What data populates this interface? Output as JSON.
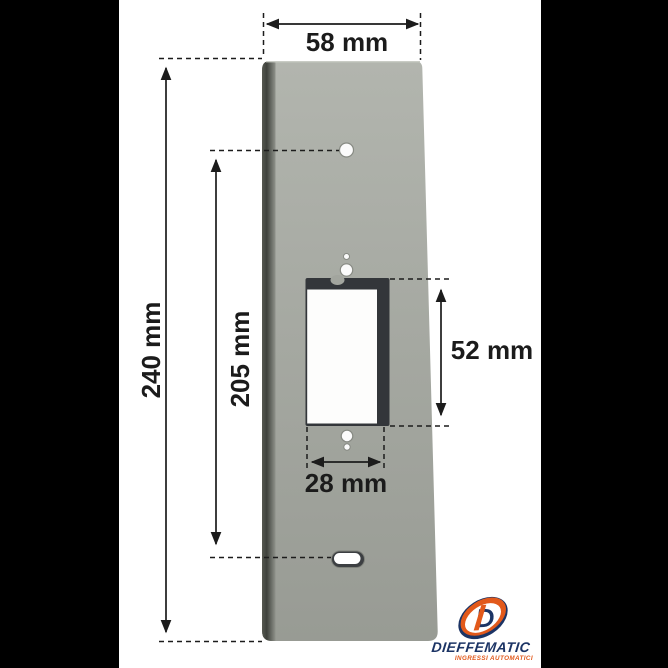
{
  "page": {
    "background": "#ffffff",
    "letterbox_color": "#000000"
  },
  "drawing": {
    "type": "dimensioned technical drawing",
    "subject": "rectangular mounting plate with central cutout, front view",
    "units": "mm",
    "labels": {
      "plate_width": "58 mm",
      "plate_height": "240 mm",
      "hole_to_slot_span": "205 mm",
      "cutout_height": "52 mm",
      "cutout_width": "28 mm"
    },
    "values": {
      "plate_width_mm": 58,
      "plate_height_mm": 240,
      "hole_to_slot_span_mm": 205,
      "cutout_height_mm": 52,
      "cutout_width_mm": 28
    },
    "features": {
      "holes": "top round hole, two small holes above cutout, two small holes below cutout, oblong slot near bottom",
      "cutout": "rectangular window with dark inner bevel on top and right"
    },
    "colors": {
      "plate": "#a7aaa3",
      "plate_edge_dark": "#474a44",
      "cutout_dark": "#33363a",
      "dimension_lines": "#1c1c1c"
    }
  },
  "logo": {
    "brand": "DIEFFEMATIC",
    "tagline": "INGRESSI AUTOMATICI",
    "monogram": "D",
    "navy": "#1c3465",
    "orange": "#e2591b"
  }
}
